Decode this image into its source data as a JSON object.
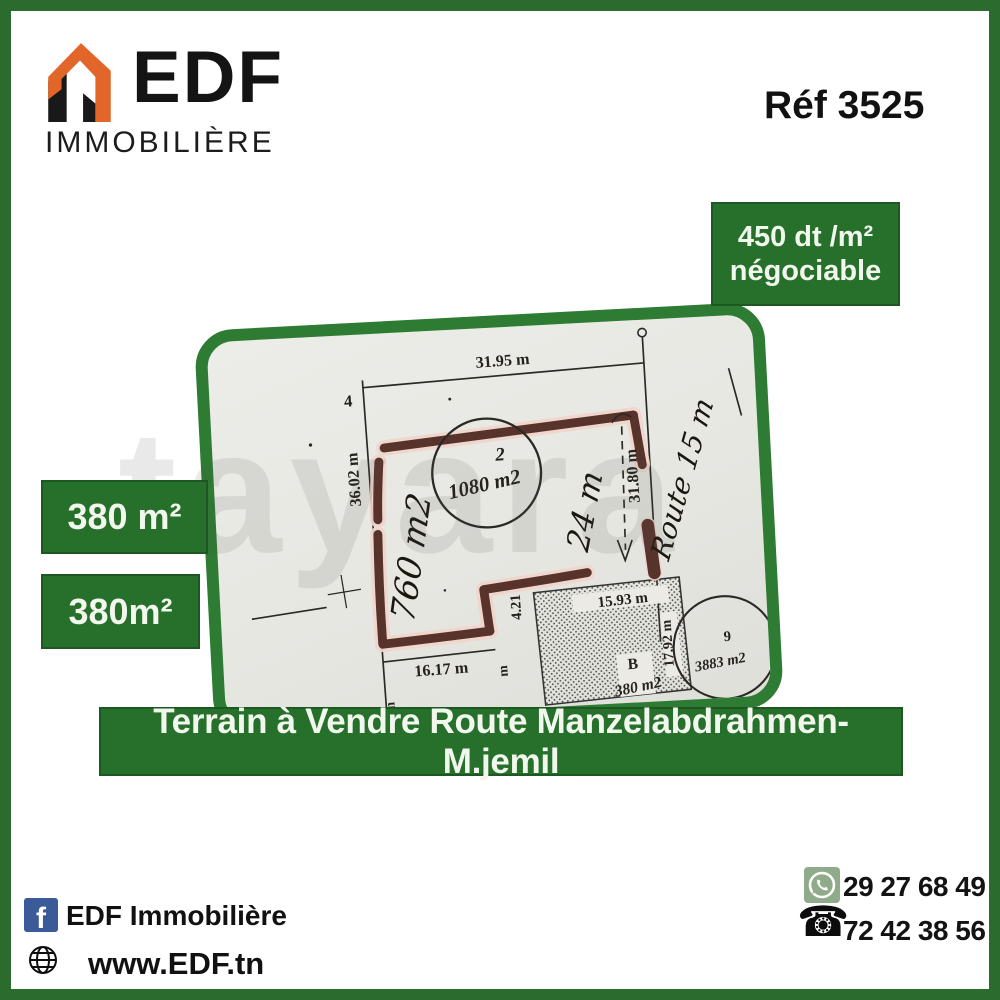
{
  "brand": {
    "name": "EDF",
    "subtitle": "IMMOBILIÈRE",
    "facebook_page": "EDF Immobilière",
    "website": "www.EDF.tn"
  },
  "header": {
    "reference": "Réf 3525"
  },
  "price_badge": {
    "line1": "450 dt /m²",
    "line2": "négociable"
  },
  "area_badges": {
    "first": "380 m²",
    "second": "380m²"
  },
  "banner": {
    "text": "Terrain à Vendre Route Manzelabdrahmen-M.jemil"
  },
  "contact": {
    "whatsapp": "29 27 68 49",
    "phone": "72 42 38 56"
  },
  "icons": {
    "facebook_glyph": "f",
    "phone_glyph": "☎"
  },
  "watermark": "tayara",
  "colors": {
    "green": "#27702c",
    "frame_green": "#2c6b2e",
    "plan_frame_green": "#2e7b33",
    "logo_orange": "#e2662a",
    "highlight_maroon": "#58332b",
    "facebook_blue": "#3a5a98"
  },
  "plan": {
    "labels": {
      "lot_left": "4",
      "dim_top": "31.95 m",
      "dim_left": "36.02 m",
      "dim_right": "31.80 m",
      "lot2_number": "2",
      "lot2_area": "1080 m2",
      "hand_area": "760 m2",
      "hand_depth": "24 m",
      "hand_route": "Route 15 m",
      "lot9_number": "9",
      "lot9_area": "3883 m2",
      "dim_b_top": "15.93 m",
      "dim_step": "4.21",
      "dim_bottom": "16.17 m",
      "dim_b_right": "17.92 m",
      "lot_b": "B",
      "lot_b_area": "380 m2",
      "unit_m": "m"
    }
  }
}
